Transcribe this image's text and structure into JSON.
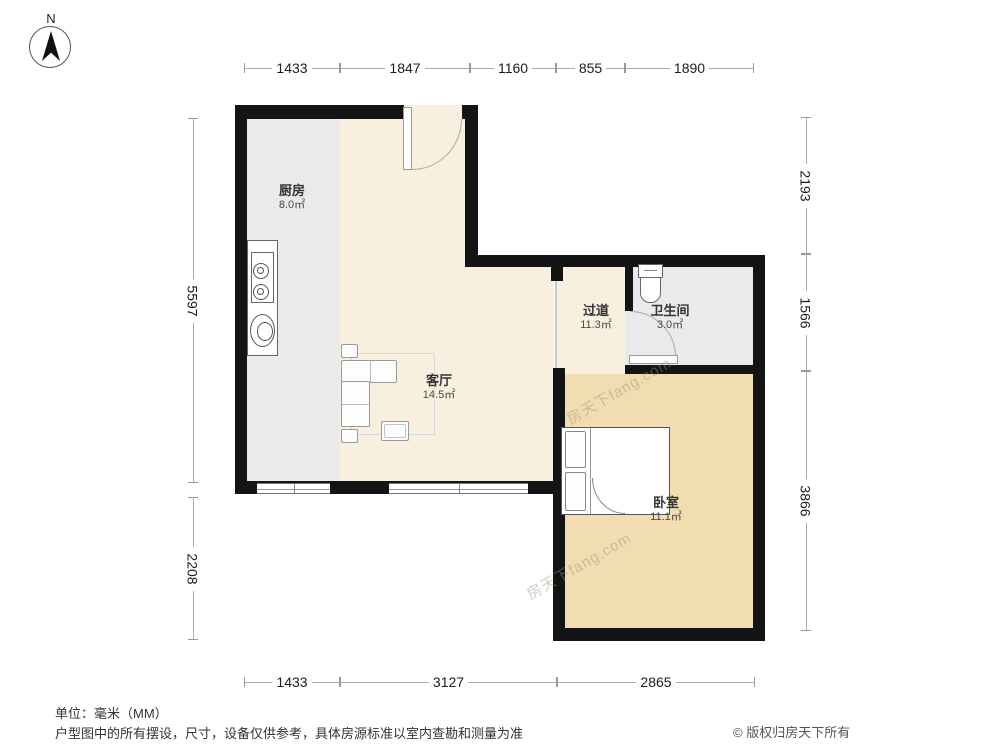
{
  "meta": {
    "north_label": "N",
    "unit_note": "单位：毫米（MM）",
    "disclaimer": "户型图中的所有摆设，尺寸，设备仅供参考，具体房源标准以室内查勘和测量为准",
    "copyright": "© 版权归房天下所有",
    "watermark": "房天下fang.com"
  },
  "colors": {
    "wall": "#141414",
    "living_floor": "#f8efdf",
    "kitchen_floor": "#eaeaea",
    "bathroom_floor": "#eaeaea",
    "bedroom_floor": "#f2dcb2"
  },
  "rooms": [
    {
      "name": "厨房",
      "area": "8.0㎡"
    },
    {
      "name": "客厅",
      "area": "14.5㎡"
    },
    {
      "name": "过道",
      "area": "11.3㎡"
    },
    {
      "name": "卫生间",
      "area": "3.0㎡"
    },
    {
      "name": "卧室",
      "area": "11.1㎡"
    }
  ],
  "dimensions": {
    "top": [
      "1433",
      "1847",
      "1160",
      "855",
      "1890"
    ],
    "bottom": [
      "1433",
      "3127",
      "2865"
    ],
    "left": [
      "5597",
      "2208"
    ],
    "right": [
      "2193",
      "1566",
      "3866"
    ]
  }
}
